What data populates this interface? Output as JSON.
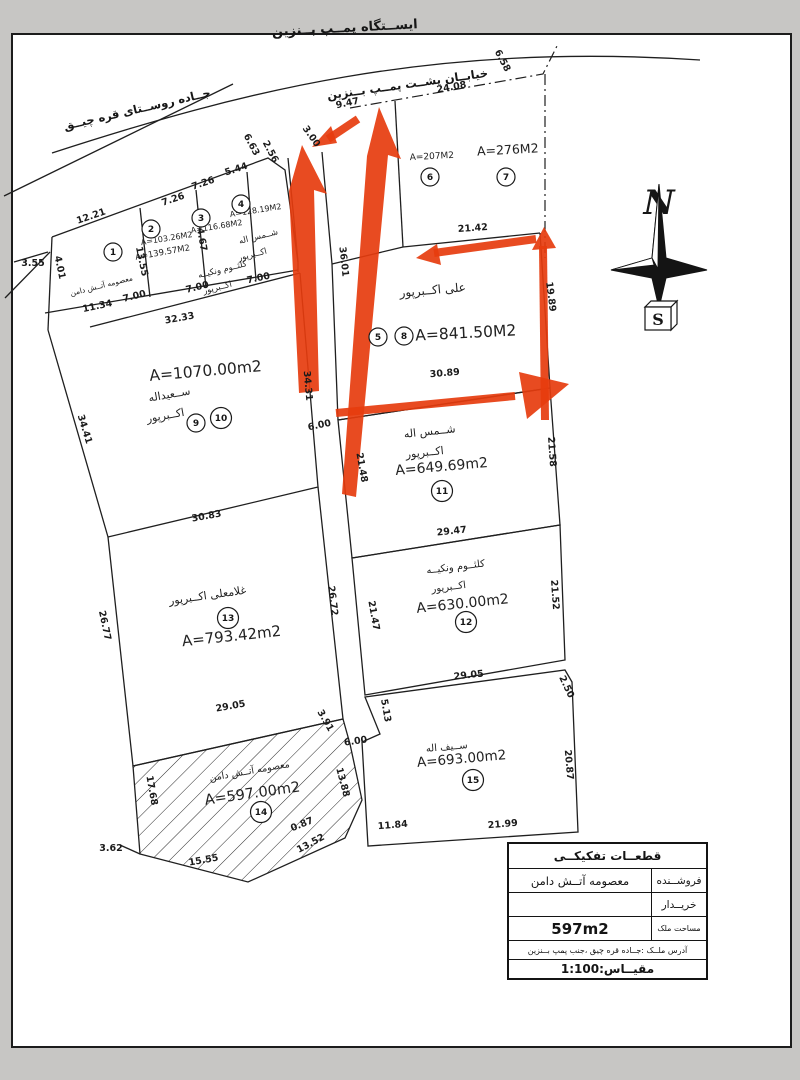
{
  "map": {
    "roads": {
      "station": "ایســتگاه پمــپ بــنزین",
      "street_behind": "خیابــان پشــت پمــپ بــنزین",
      "village": "جــاده روســتای قره چیــق"
    },
    "compass": {
      "north": "N",
      "south": "S"
    },
    "colors": {
      "arrow": "#e63c0e",
      "ink": "#1b1b1b",
      "paper": "#ffffff"
    },
    "scale_note": "1:100",
    "parcels": [
      {
        "num": "1",
        "area": "A=139.57M2",
        "owner": "معصومه آتــش دامن"
      },
      {
        "num": "2",
        "area": "A=103.26M2",
        "owner": "کلثــوم ونکیــه اکــبرپور"
      },
      {
        "num": "3",
        "area": "A=116.68M2",
        "owner": "کلثــوم ونکیــه اکــبرپور"
      },
      {
        "num": "4",
        "area": "A=128.19M2",
        "owner": "شــمس اله اکــبرپور"
      },
      {
        "num": "5/8",
        "area": "A=841.50M2",
        "owner": "علی اکــبرپور"
      },
      {
        "num": "6",
        "area": "A=207M2",
        "owner": ""
      },
      {
        "num": "7",
        "area": "A=276M2",
        "owner": ""
      },
      {
        "num": "9/10",
        "area": "A=1070.00m2",
        "owner": "ســعیداله اکــبرپور"
      },
      {
        "num": "11",
        "area": "A=649.69m2",
        "owner": "شــمس اله اکــبرپور"
      },
      {
        "num": "12",
        "area": "A=630.00m2",
        "owner": "کلثــوم ونکیــه اکــبرپور"
      },
      {
        "num": "13",
        "area": "A=793.42m2",
        "owner": "غلامعلی اکــبرپور"
      },
      {
        "num": "14",
        "area": "A=597.00m2",
        "owner": "معصومه آتــش دامن"
      },
      {
        "num": "15",
        "area": "A=693.00m2",
        "owner": "ســیف اله"
      }
    ],
    "circles": [
      {
        "x": 113,
        "y": 252,
        "n": "1"
      },
      {
        "x": 151,
        "y": 229,
        "n": "2"
      },
      {
        "x": 201,
        "y": 218,
        "n": "3"
      },
      {
        "x": 241,
        "y": 204,
        "n": "4"
      },
      {
        "x": 430,
        "y": 177,
        "n": "6"
      },
      {
        "x": 506,
        "y": 177,
        "n": "7"
      },
      {
        "x": 378,
        "y": 337,
        "n": "5"
      },
      {
        "x": 404,
        "y": 336,
        "n": "8"
      },
      {
        "x": 196,
        "y": 423,
        "n": "9"
      },
      {
        "x": 221,
        "y": 418,
        "n": "10"
      },
      {
        "x": 442,
        "y": 491,
        "n": "11"
      },
      {
        "x": 466,
        "y": 622,
        "n": "12"
      },
      {
        "x": 228,
        "y": 618,
        "n": "13"
      },
      {
        "x": 261,
        "y": 812,
        "n": "14"
      },
      {
        "x": 473,
        "y": 780,
        "n": "15"
      }
    ],
    "labels": [
      {
        "t": "A=139.57M2",
        "x": 163,
        "y": 255,
        "r": -10,
        "s": 8.5
      },
      {
        "t": "معصومه آتــش دامن",
        "x": 102,
        "y": 288,
        "r": -14,
        "s": 7.5
      },
      {
        "t": "A=103.26M2",
        "x": 167,
        "y": 241,
        "r": -9,
        "s": 8
      },
      {
        "t": "A=116.68M2",
        "x": 217,
        "y": 229,
        "r": -9,
        "s": 8
      },
      {
        "t": "A=128.19M2",
        "x": 256,
        "y": 213,
        "r": -9,
        "s": 8
      },
      {
        "t": "شــمس اله",
        "x": 259,
        "y": 239,
        "r": -14,
        "s": 8.5
      },
      {
        "t": "اکــبرپور",
        "x": 253,
        "y": 257,
        "r": -14,
        "s": 8.5
      },
      {
        "t": "کلثــوم ونکیــه",
        "x": 223,
        "y": 272,
        "r": -14,
        "s": 8.5
      },
      {
        "t": "اکــبرپور",
        "x": 218,
        "y": 290,
        "r": -14,
        "s": 8.5
      },
      {
        "t": "A=207M2",
        "x": 432,
        "y": 159,
        "r": -3,
        "s": 9
      },
      {
        "t": "A=276M2",
        "x": 508,
        "y": 154,
        "r": -3,
        "s": 12.5
      },
      {
        "t": "علی اکــبرپور",
        "x": 433,
        "y": 294,
        "r": -5,
        "s": 12
      },
      {
        "t": "A=841.50M2",
        "x": 466,
        "y": 338,
        "r": -3,
        "s": 15.5
      },
      {
        "t": "A=1070.00m2",
        "x": 206,
        "y": 376,
        "r": -5,
        "s": 15.5
      },
      {
        "t": "ســعیداله",
        "x": 170,
        "y": 398,
        "r": -10,
        "s": 11
      },
      {
        "t": "اکــبرپور",
        "x": 166,
        "y": 419,
        "r": -10,
        "s": 11
      },
      {
        "t": "شــمس اله",
        "x": 430,
        "y": 435,
        "r": -6,
        "s": 11
      },
      {
        "t": "اکــبرپور",
        "x": 425,
        "y": 456,
        "r": -6,
        "s": 11
      },
      {
        "t": "A=649.69m2",
        "x": 442,
        "y": 471,
        "r": -5,
        "s": 14
      },
      {
        "t": "کلثــوم ونکیــه",
        "x": 456,
        "y": 570,
        "r": -7,
        "s": 10
      },
      {
        "t": "اکــبرپور",
        "x": 449,
        "y": 590,
        "r": -7,
        "s": 10
      },
      {
        "t": "A=630.00m2",
        "x": 463,
        "y": 608,
        "r": -6,
        "s": 14
      },
      {
        "t": "غلامعلی اکــبرپور",
        "x": 208,
        "y": 599,
        "r": -8,
        "s": 11
      },
      {
        "t": "A=793.42m2",
        "x": 232,
        "y": 641,
        "r": -6,
        "s": 15
      },
      {
        "t": "معصومه آتــش دامن",
        "x": 250,
        "y": 774,
        "r": -10,
        "s": 9.5
      },
      {
        "t": "A=597.00m2",
        "x": 253,
        "y": 798,
        "r": -8,
        "s": 14.5
      },
      {
        "t": "ســیف اله",
        "x": 447,
        "y": 750,
        "r": -5,
        "s": 10
      },
      {
        "t": "A=693.00m2",
        "x": 462,
        "y": 763,
        "r": -5,
        "s": 13.5
      }
    ],
    "dimensions": [
      {
        "t": "9.47",
        "x": 348,
        "y": 106,
        "r": -12
      },
      {
        "t": "24.08",
        "x": 452,
        "y": 90,
        "r": -10
      },
      {
        "t": "6.58",
        "x": 500,
        "y": 62,
        "r": 62
      },
      {
        "t": "3.00",
        "x": 309,
        "y": 138,
        "r": 55
      },
      {
        "t": "6.63",
        "x": 249,
        "y": 146,
        "r": 62
      },
      {
        "t": "2.56",
        "x": 268,
        "y": 153,
        "r": 62
      },
      {
        "t": "5.44",
        "x": 237,
        "y": 172,
        "r": -18
      },
      {
        "t": "7.26",
        "x": 204,
        "y": 186,
        "r": -19
      },
      {
        "t": "7.26",
        "x": 174,
        "y": 202,
        "r": -19
      },
      {
        "t": "12.21",
        "x": 92,
        "y": 219,
        "r": -19
      },
      {
        "t": "3.55",
        "x": 33,
        "y": 266,
        "r": 0
      },
      {
        "t": "4.01",
        "x": 57,
        "y": 268,
        "r": 78
      },
      {
        "t": "13.55",
        "x": 139,
        "y": 262,
        "r": 78
      },
      {
        "t": "4.67",
        "x": 199,
        "y": 240,
        "r": 80
      },
      {
        "t": "11.34",
        "x": 98,
        "y": 309,
        "r": -12
      },
      {
        "t": "7.00",
        "x": 135,
        "y": 299,
        "r": -14
      },
      {
        "t": "7.00",
        "x": 198,
        "y": 290,
        "r": -14
      },
      {
        "t": "7.00",
        "x": 259,
        "y": 281,
        "r": -12
      },
      {
        "t": "32.33",
        "x": 180,
        "y": 321,
        "r": -10
      },
      {
        "t": "21.42",
        "x": 473,
        "y": 231,
        "r": -4
      },
      {
        "t": "36.01",
        "x": 341,
        "y": 262,
        "r": 84
      },
      {
        "t": "19.89",
        "x": 548,
        "y": 297,
        "r": 83
      },
      {
        "t": "30.89",
        "x": 445,
        "y": 376,
        "r": -5
      },
      {
        "t": "34.41",
        "x": 82,
        "y": 430,
        "r": 73
      },
      {
        "t": "34.31",
        "x": 305,
        "y": 386,
        "r": 85
      },
      {
        "t": "6.00",
        "x": 320,
        "y": 428,
        "r": -12
      },
      {
        "t": "21.48",
        "x": 359,
        "y": 468,
        "r": 80
      },
      {
        "t": "21.58",
        "x": 549,
        "y": 452,
        "r": 86
      },
      {
        "t": "30.83",
        "x": 207,
        "y": 519,
        "r": -10
      },
      {
        "t": "29.47",
        "x": 452,
        "y": 534,
        "r": -6
      },
      {
        "t": "26.77",
        "x": 102,
        "y": 626,
        "r": 78
      },
      {
        "t": "26.72",
        "x": 330,
        "y": 601,
        "r": 83
      },
      {
        "t": "21.47",
        "x": 371,
        "y": 616,
        "r": 80
      },
      {
        "t": "21.52",
        "x": 552,
        "y": 595,
        "r": 86
      },
      {
        "t": "29.05",
        "x": 469,
        "y": 678,
        "r": -6
      },
      {
        "t": "2.50",
        "x": 564,
        "y": 688,
        "r": 65
      },
      {
        "t": "29.05",
        "x": 231,
        "y": 709,
        "r": -10
      },
      {
        "t": "3.91",
        "x": 323,
        "y": 722,
        "r": 60
      },
      {
        "t": "5.13",
        "x": 383,
        "y": 711,
        "r": 80
      },
      {
        "t": "6.00",
        "x": 356,
        "y": 744,
        "r": -8
      },
      {
        "t": "17.68",
        "x": 149,
        "y": 791,
        "r": 80
      },
      {
        "t": "13.88",
        "x": 340,
        "y": 783,
        "r": 75
      },
      {
        "t": "0.87",
        "x": 303,
        "y": 827,
        "r": -22
      },
      {
        "t": "13.52",
        "x": 312,
        "y": 846,
        "r": -28
      },
      {
        "t": "15.55",
        "x": 204,
        "y": 863,
        "r": -10
      },
      {
        "t": "3.62",
        "x": 111,
        "y": 851,
        "r": 0
      },
      {
        "t": "11.84",
        "x": 393,
        "y": 828,
        "r": -5
      },
      {
        "t": "21.99",
        "x": 503,
        "y": 827,
        "r": -5
      },
      {
        "t": "20.87",
        "x": 566,
        "y": 765,
        "r": 85
      }
    ]
  },
  "table": {
    "title": "قطعــات تفکیکــی",
    "seller_label": "فروشــنده",
    "seller_value": "معصومه آتــش دامن",
    "buyer_label": "خریــدار",
    "buyer_value": "",
    "area_label": "مساحت ملک",
    "area_value": "597m2",
    "address": "آدرس ملــک :جــاده قره چیق ،جنب پمپ بــنزین",
    "scale": "مقیــاس:1:100"
  }
}
